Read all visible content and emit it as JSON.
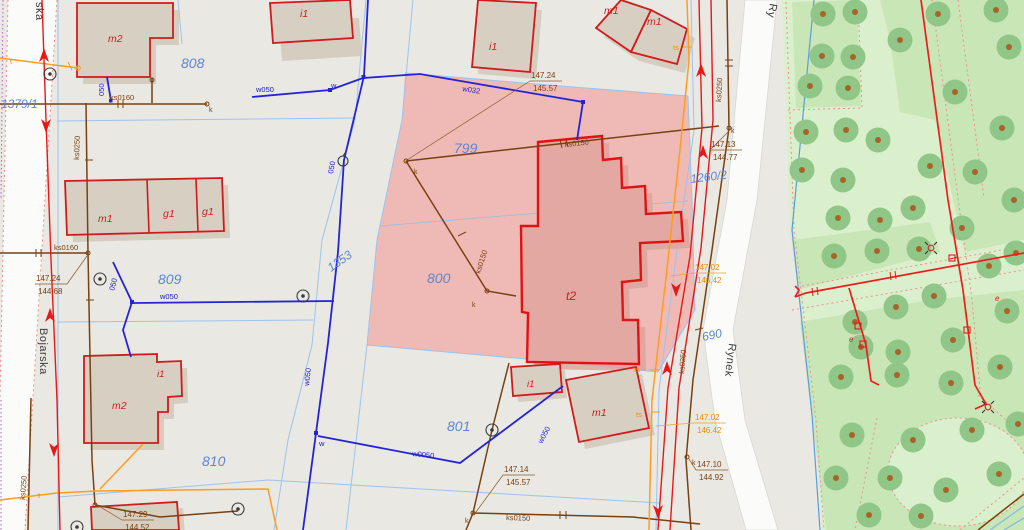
{
  "streets": {
    "left_name": "Bojarska",
    "left_name_fragment": "ska",
    "right_name": "Rynek",
    "right_name_fragment": "Ry"
  },
  "parcels": {
    "p1379_1": "1379/1",
    "p808": "808",
    "p809": "809",
    "p810": "810",
    "p1353": "1353",
    "p799": "799",
    "p800": "800",
    "p801": "801",
    "p1260_2": "1260/2",
    "p690": "690"
  },
  "buildings": {
    "m2_nw": "m2",
    "i1_n": "i1",
    "i1_nc": "i1",
    "m1_ne_1": "m1",
    "m1_ne_2": "m1",
    "m1_w": "m1",
    "g1_w1": "g1",
    "g1_w2": "g1",
    "m2_sw": "m2",
    "i1_sw": "i1",
    "t2_c": "t2",
    "i1_s": "i1",
    "m1_s": "m1"
  },
  "utilities": {
    "water": {
      "w050_a": "w050",
      "w050_b": "w050",
      "w050_c": "w050",
      "w050_d": "w050",
      "d050_a": "050",
      "d050_b": "050",
      "d050_c": "050",
      "w032": "w032",
      "w0050": "w0050",
      "w_node": "w"
    },
    "sewer": {
      "ks0160_a": "ks0160",
      "ks0160_b": "ks0160",
      "ks0250_a": "ks0250",
      "ks0250_b": "ks0250",
      "ks0250_c": "ks0250",
      "ks0250_d": "ks0250",
      "ks0150_a": "ks0150",
      "ks0150_b": "ks0150",
      "ks0150_c": "ks0150",
      "k_node": "k"
    },
    "telecom": {
      "ts_a": "ts",
      "ts_b": "ts",
      "ts_c": "ts",
      "t_a": "t",
      "t_b": "t"
    },
    "power": {
      "e_a": "e",
      "e_b": "e"
    }
  },
  "elevations": {
    "e1": {
      "top": "147.24",
      "bottom": "145.57"
    },
    "e2": {
      "top": "147.13",
      "bottom": "144.77"
    },
    "e3": {
      "top": "147.24",
      "bottom": "144.68"
    },
    "e4": {
      "top": "147.29",
      "bottom": "144.52"
    },
    "e5": {
      "top": "147.14",
      "bottom": "145.57"
    },
    "e6": {
      "top": "147.02",
      "bottom": "146.42"
    },
    "e7": {
      "top": "147.10",
      "bottom": "144.92"
    },
    "e8": {
      "top": "147.02",
      "bottom": "146.42"
    }
  },
  "colors": {
    "background": "#e9e8e3",
    "street_band": "#fbfbf9",
    "parcel_number": "#5b87d6",
    "building_label": "#cc2020",
    "building_fill": "#d8cfc3",
    "building_outline": "#cf1b1b",
    "highlight_parcel": "#efbab5",
    "highlight_building": "#e3a8a2",
    "water": "#2424d6",
    "sewer": "#7a4010",
    "telecom": "#ff9d1e",
    "power": "#e81818",
    "boundary": "#9cc3ee",
    "park": "#daefcc",
    "lawn": "#c9e6b6",
    "tree": "#90c687",
    "tree_dot": "#a86428"
  },
  "park": {
    "trees": [
      [
        823,
        14
      ],
      [
        855,
        12
      ],
      [
        938,
        14
      ],
      [
        996,
        10
      ],
      [
        900,
        40
      ],
      [
        822,
        56
      ],
      [
        853,
        57
      ],
      [
        1009,
        47
      ],
      [
        810,
        86
      ],
      [
        848,
        88
      ],
      [
        955,
        92
      ],
      [
        806,
        132
      ],
      [
        846,
        130
      ],
      [
        878,
        140
      ],
      [
        1002,
        128
      ],
      [
        802,
        170
      ],
      [
        843,
        180
      ],
      [
        930,
        166
      ],
      [
        975,
        172
      ],
      [
        838,
        218
      ],
      [
        880,
        220
      ],
      [
        913,
        208
      ],
      [
        962,
        228
      ],
      [
        1014,
        200
      ],
      [
        834,
        256
      ],
      [
        877,
        251
      ],
      [
        919,
        249
      ],
      [
        989,
        266
      ],
      [
        1016,
        253
      ],
      [
        855,
        322
      ],
      [
        896,
        307
      ],
      [
        934,
        296
      ],
      [
        1007,
        311
      ],
      [
        861,
        347
      ],
      [
        898,
        352
      ],
      [
        953,
        340
      ],
      [
        841,
        377
      ],
      [
        897,
        375
      ],
      [
        951,
        383
      ],
      [
        1000,
        367
      ],
      [
        852,
        435
      ],
      [
        913,
        440
      ],
      [
        972,
        430
      ],
      [
        1018,
        424
      ],
      [
        836,
        478
      ],
      [
        890,
        478
      ],
      [
        946,
        490
      ],
      [
        999,
        474
      ],
      [
        869,
        515
      ],
      [
        921,
        516
      ]
    ]
  }
}
